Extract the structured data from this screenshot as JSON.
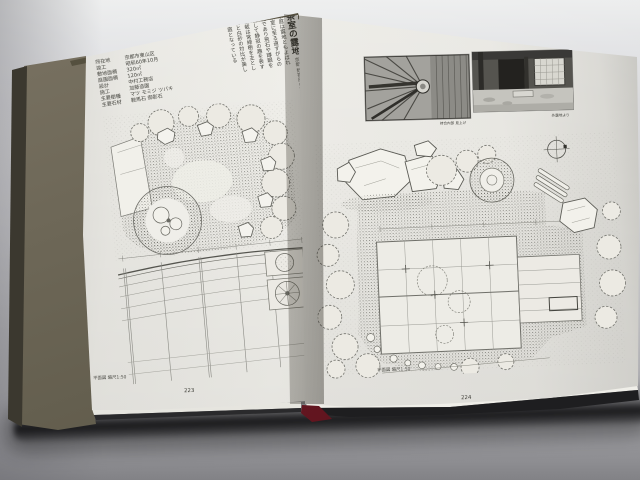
{
  "photo_subject": "Open book of Japanese garden design plans on gray surface",
  "book": {
    "left_page": {
      "page_number": "223",
      "caption": "平面図 縮尺1:50",
      "footer": "茶庭 露地の設計",
      "article_title": "茶室の露地",
      "article_subtitle": "京都 数寄屋の庭",
      "spec_table": {
        "rows": [
          {
            "label": "所在地",
            "value": "京都市東山区"
          },
          {
            "label": "竣工",
            "value": "昭和60年10月"
          },
          {
            "label": "敷地面積",
            "value": "320㎡"
          },
          {
            "label": "庭園面積",
            "value": "120㎡"
          },
          {
            "label": "設計",
            "value": "中村工務店"
          },
          {
            "label": "施工",
            "value": "加藤造園"
          },
          {
            "label": "主要樹種",
            "value": "マツ モミジ ツバキ"
          },
          {
            "label": "主要石材",
            "value": "鞍馬石 御影石"
          }
        ]
      },
      "body_columns": [
        "茶庭は露地ともよばれ",
        "茶室に至る道すがらの",
        "庭であり飛石や蹲踞を",
        "配して静寂の趣を表す",
        "植栽は常緑樹を主とし",
        "苔と白砂の対比が美し",
        "い庭となっている"
      ]
    },
    "right_page": {
      "page_number": "224",
      "caption": "平面図 縮尺1:50",
      "photos": [
        {
          "caption": "待合内部 見上げ"
        },
        {
          "caption": "外露地より"
        }
      ]
    }
  }
}
